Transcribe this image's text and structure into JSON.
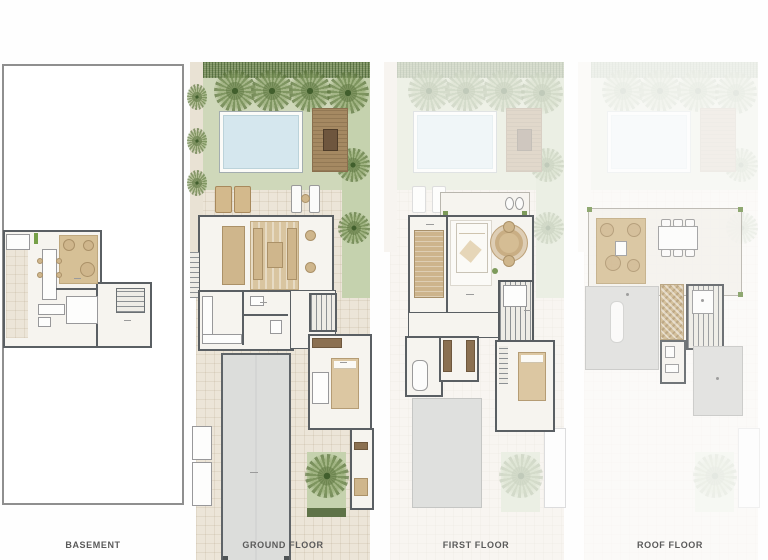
{
  "document": {
    "type": "architectural-floor-plan-sheet",
    "background_color": "#fefefe"
  },
  "floors": [
    {
      "id": "basement",
      "label": "BASEMENT"
    },
    {
      "id": "ground-floor",
      "label": "GROUND FLOOR"
    },
    {
      "id": "first-floor",
      "label": "FIRST FLOOR"
    },
    {
      "id": "roof-floor",
      "label": "ROOF FLOOR"
    }
  ],
  "colors": {
    "wall": "#5a5f63",
    "paving": "#ece5d8",
    "lawn": "#cfd8ba",
    "hedge": "#7c9160",
    "pool_water": "#d5e7ee",
    "wood_deck": "#a58962",
    "furniture_tan": "#d9c5a0",
    "garage_slab": "#dcdddb",
    "label_text": "#5a5a5a"
  },
  "features": {
    "basement": [
      "plot-outline",
      "lounge-rug",
      "long-table",
      "kitchenette",
      "staircase",
      "corridor-tiles"
    ],
    "ground_floor": [
      "boundary-hedge",
      "palm-trees",
      "swimming-pool",
      "wood-deck-pergola",
      "sun-loungers",
      "lawn",
      "living-dining-room",
      "area-rug",
      "kitchen",
      "stairwell",
      "master-bedroom",
      "garage",
      "palm-courtyard",
      "entry-rooms"
    ],
    "first_floor": [
      "ghosted-garden",
      "roof-terrace-balcony",
      "dressing-room",
      "master-bedroom",
      "round-rug-lounge",
      "bathroom-with-tub",
      "stairwell",
      "second-bedroom",
      "garage-roof-slab"
    ],
    "roof_floor": [
      "ghosted-lower-floors",
      "roof-terrace",
      "outdoor-lounge-rug",
      "outdoor-dining-table",
      "roof-slab-with-skylight",
      "pergola-mosaic",
      "stairwell",
      "wc",
      "roof-slab"
    ]
  }
}
